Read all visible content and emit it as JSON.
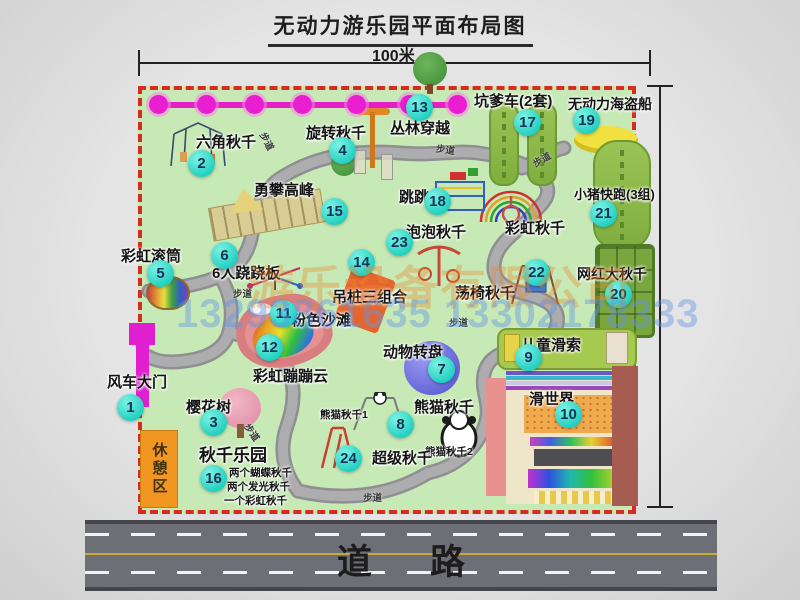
{
  "title": "无动力游乐园平面布局图",
  "dimensions": {
    "top": "100米",
    "right": "120米"
  },
  "road": {
    "label": "道路"
  },
  "rest_area": {
    "label": "休憩区"
  },
  "walkway_label": "步道",
  "watermark": {
    "company": "游乐设备有限公司",
    "phones": "13293861635 13302178333"
  },
  "extras": {
    "rainbow_swing": "彩虹秋千"
  },
  "stations": [
    {
      "num": "1",
      "label": "风车大门"
    },
    {
      "num": "2",
      "label": "六角秋千"
    },
    {
      "num": "3",
      "label": "樱花树"
    },
    {
      "num": "4",
      "label": "旋转秋千"
    },
    {
      "num": "5",
      "label": "彩虹滚筒"
    },
    {
      "num": "6",
      "label": "6人跷跷板"
    },
    {
      "num": "7",
      "label": "动物转盘"
    },
    {
      "num": "8",
      "label": "熊猫秋千",
      "subs": [
        "熊猫秋千1",
        "熊猫秋千2"
      ]
    },
    {
      "num": "9",
      "label": "儿童滑索"
    },
    {
      "num": "10",
      "label": "滑世界"
    },
    {
      "num": "11",
      "label": "粉色沙滩"
    },
    {
      "num": "12",
      "label": "彩虹蹦蹦云"
    },
    {
      "num": "13",
      "label": "丛林穿越"
    },
    {
      "num": "14",
      "label": "吊桩三组合"
    },
    {
      "num": "15",
      "label": "勇攀高峰"
    },
    {
      "num": "16",
      "label": "秋千乐园",
      "subs": [
        "两个蝴蝶秋千",
        "两个发光秋千",
        "一个彩虹秋千"
      ]
    },
    {
      "num": "17",
      "label": "坑爹车(2套)"
    },
    {
      "num": "18",
      "label": "跳跳马"
    },
    {
      "num": "19",
      "label": "无动力海盗船"
    },
    {
      "num": "20",
      "label": "网红大秋千"
    },
    {
      "num": "21",
      "label": "小猪快跑(3组)"
    },
    {
      "num": "22",
      "label": "荡椅秋千"
    },
    {
      "num": "23",
      "label": "泡泡秋千"
    },
    {
      "num": "24",
      "label": "超级秋千"
    }
  ],
  "colors": {
    "park_green": "#c7e9b6",
    "border_red": "#d62b1e",
    "chain_magenta": "#e61ec8",
    "marker_cyan": "#1ecfbf",
    "road_gray": "#6e6e76",
    "rest_orange": "#f29622",
    "gate_magenta": "#e020d0",
    "pirate_yellow": "#f0e040"
  }
}
